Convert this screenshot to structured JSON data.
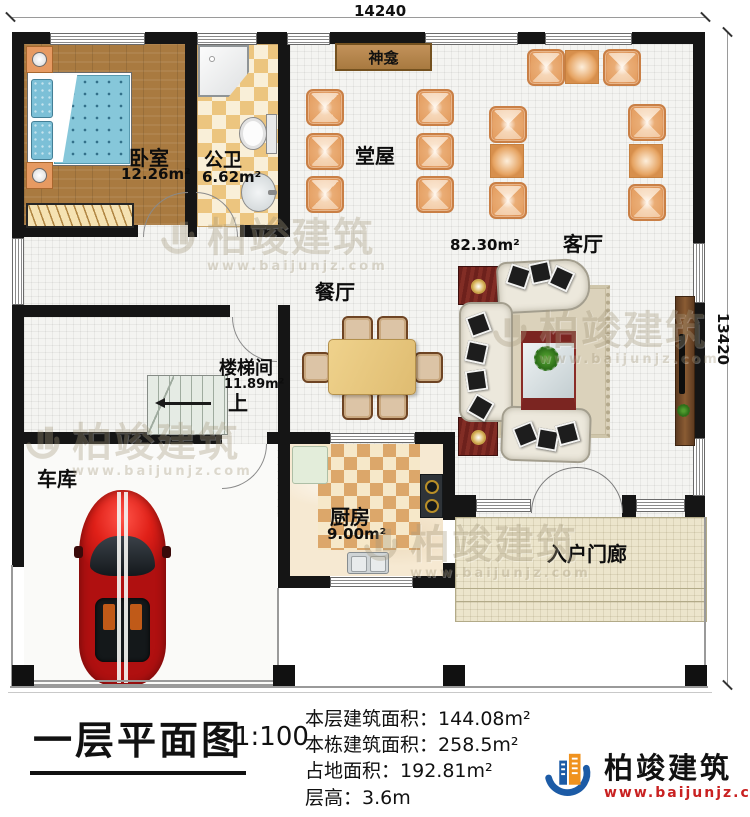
{
  "dimensions": {
    "top": "14240",
    "right": "13420"
  },
  "rooms": {
    "bedroom": {
      "label": "卧室",
      "area": "12.26m²"
    },
    "bathroom": {
      "label": "公卫",
      "area": "6.62m²"
    },
    "shrine": {
      "label": "神龛"
    },
    "hall": {
      "label": "堂屋"
    },
    "open_area": {
      "area": "82.30m²"
    },
    "living": {
      "label": "客厅"
    },
    "dining": {
      "label": "餐厅"
    },
    "stairwell": {
      "label": "楼梯间",
      "area": "11.89m²",
      "direction": "上"
    },
    "garage": {
      "label": "车库"
    },
    "kitchen": {
      "label": "厨房",
      "area": "9.00m²"
    },
    "porch": {
      "label": "入户门廊"
    }
  },
  "footer": {
    "title": "一层平面图",
    "scale": "1:100",
    "stats": [
      {
        "label": "本层建筑面积：",
        "value": "144.08m²"
      },
      {
        "label": "本栋建筑面积：",
        "value": "258.5m²"
      },
      {
        "label": "占地面积：",
        "value": "192.81m²"
      },
      {
        "label": "层高：",
        "value": "3.6m"
      }
    ]
  },
  "brand": {
    "name": "柏竣建筑",
    "website": "www.baijunjz.com"
  },
  "colors": {
    "wall": "#151515",
    "chair_orange": "#de9559",
    "shrine_brown": "#a87a40",
    "brand_blue": "#1c5ba6",
    "brand_orange": "#f0921e",
    "url_red": "#c92121",
    "car_red": "#d41414"
  }
}
